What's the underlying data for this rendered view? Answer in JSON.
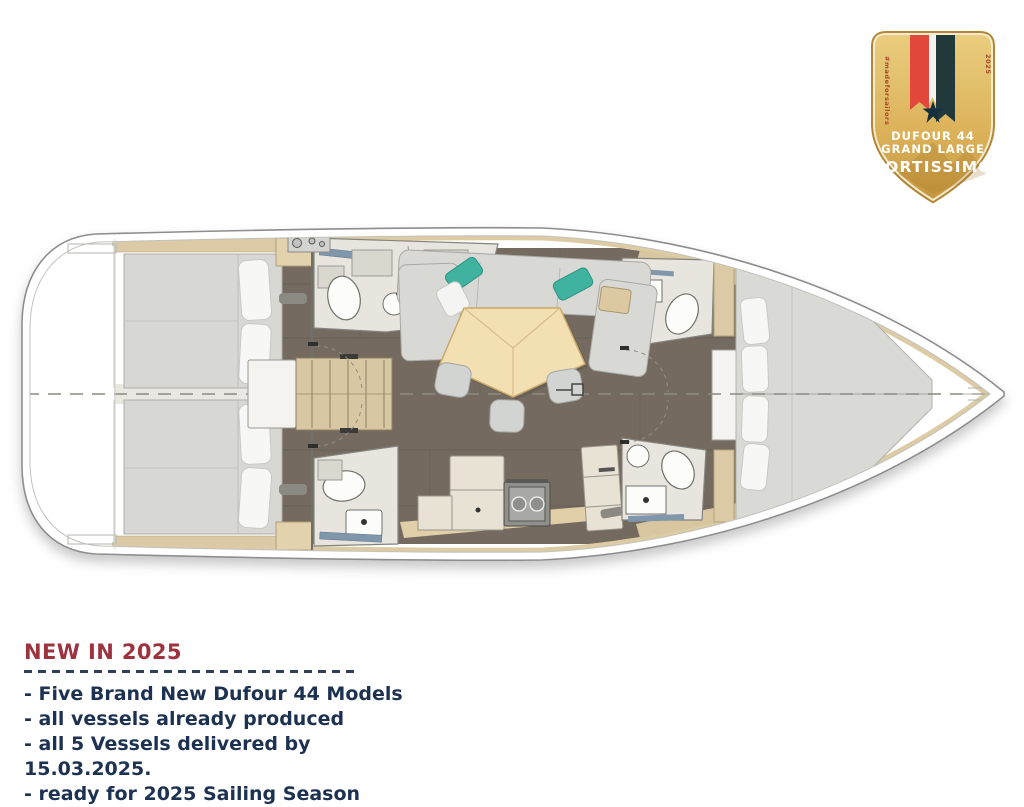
{
  "badge": {
    "model": "DUFOUR 44",
    "range": "GRAND LARGE",
    "name": "FORTISSIMO",
    "hashtag": "#madeforsailors",
    "year": "2025",
    "colors": {
      "gold": "#ddb45c",
      "gold_dark": "#b28634",
      "ribbon_red": "#e2473c",
      "ribbon_white": "#f5f3ee",
      "ribbon_dark": "#22393c",
      "star": "#16303d",
      "text": "#ffffff"
    }
  },
  "floorplan": {
    "colors": {
      "hull": "#ffffff",
      "hull_line": "#8d8d8d",
      "floor": "#746a5f",
      "wood_trim": "#ddcba4",
      "mattress": "#d9d9d6",
      "pillow": "#f7f7f5",
      "sofa": "#d8d8d5",
      "sofa_pillow_teal": "#3fb3a0",
      "table_wood": "#f2dfb2",
      "bathroom": "#e8e5de",
      "counter": "#e7e2d4",
      "stove": "#8f8f8c"
    }
  },
  "footer": {
    "heading": "NEW IN 2025",
    "items": [
      "- Five Brand New Dufour 44 Models",
      "- all vessels already produced",
      "- all 5 Vessels delivered by 15.03.2025.",
      "- ready for 2025 Sailing Season"
    ],
    "colors": {
      "heading": "#9e3340",
      "text": "#1d3150",
      "divider": "#2e4057"
    }
  }
}
